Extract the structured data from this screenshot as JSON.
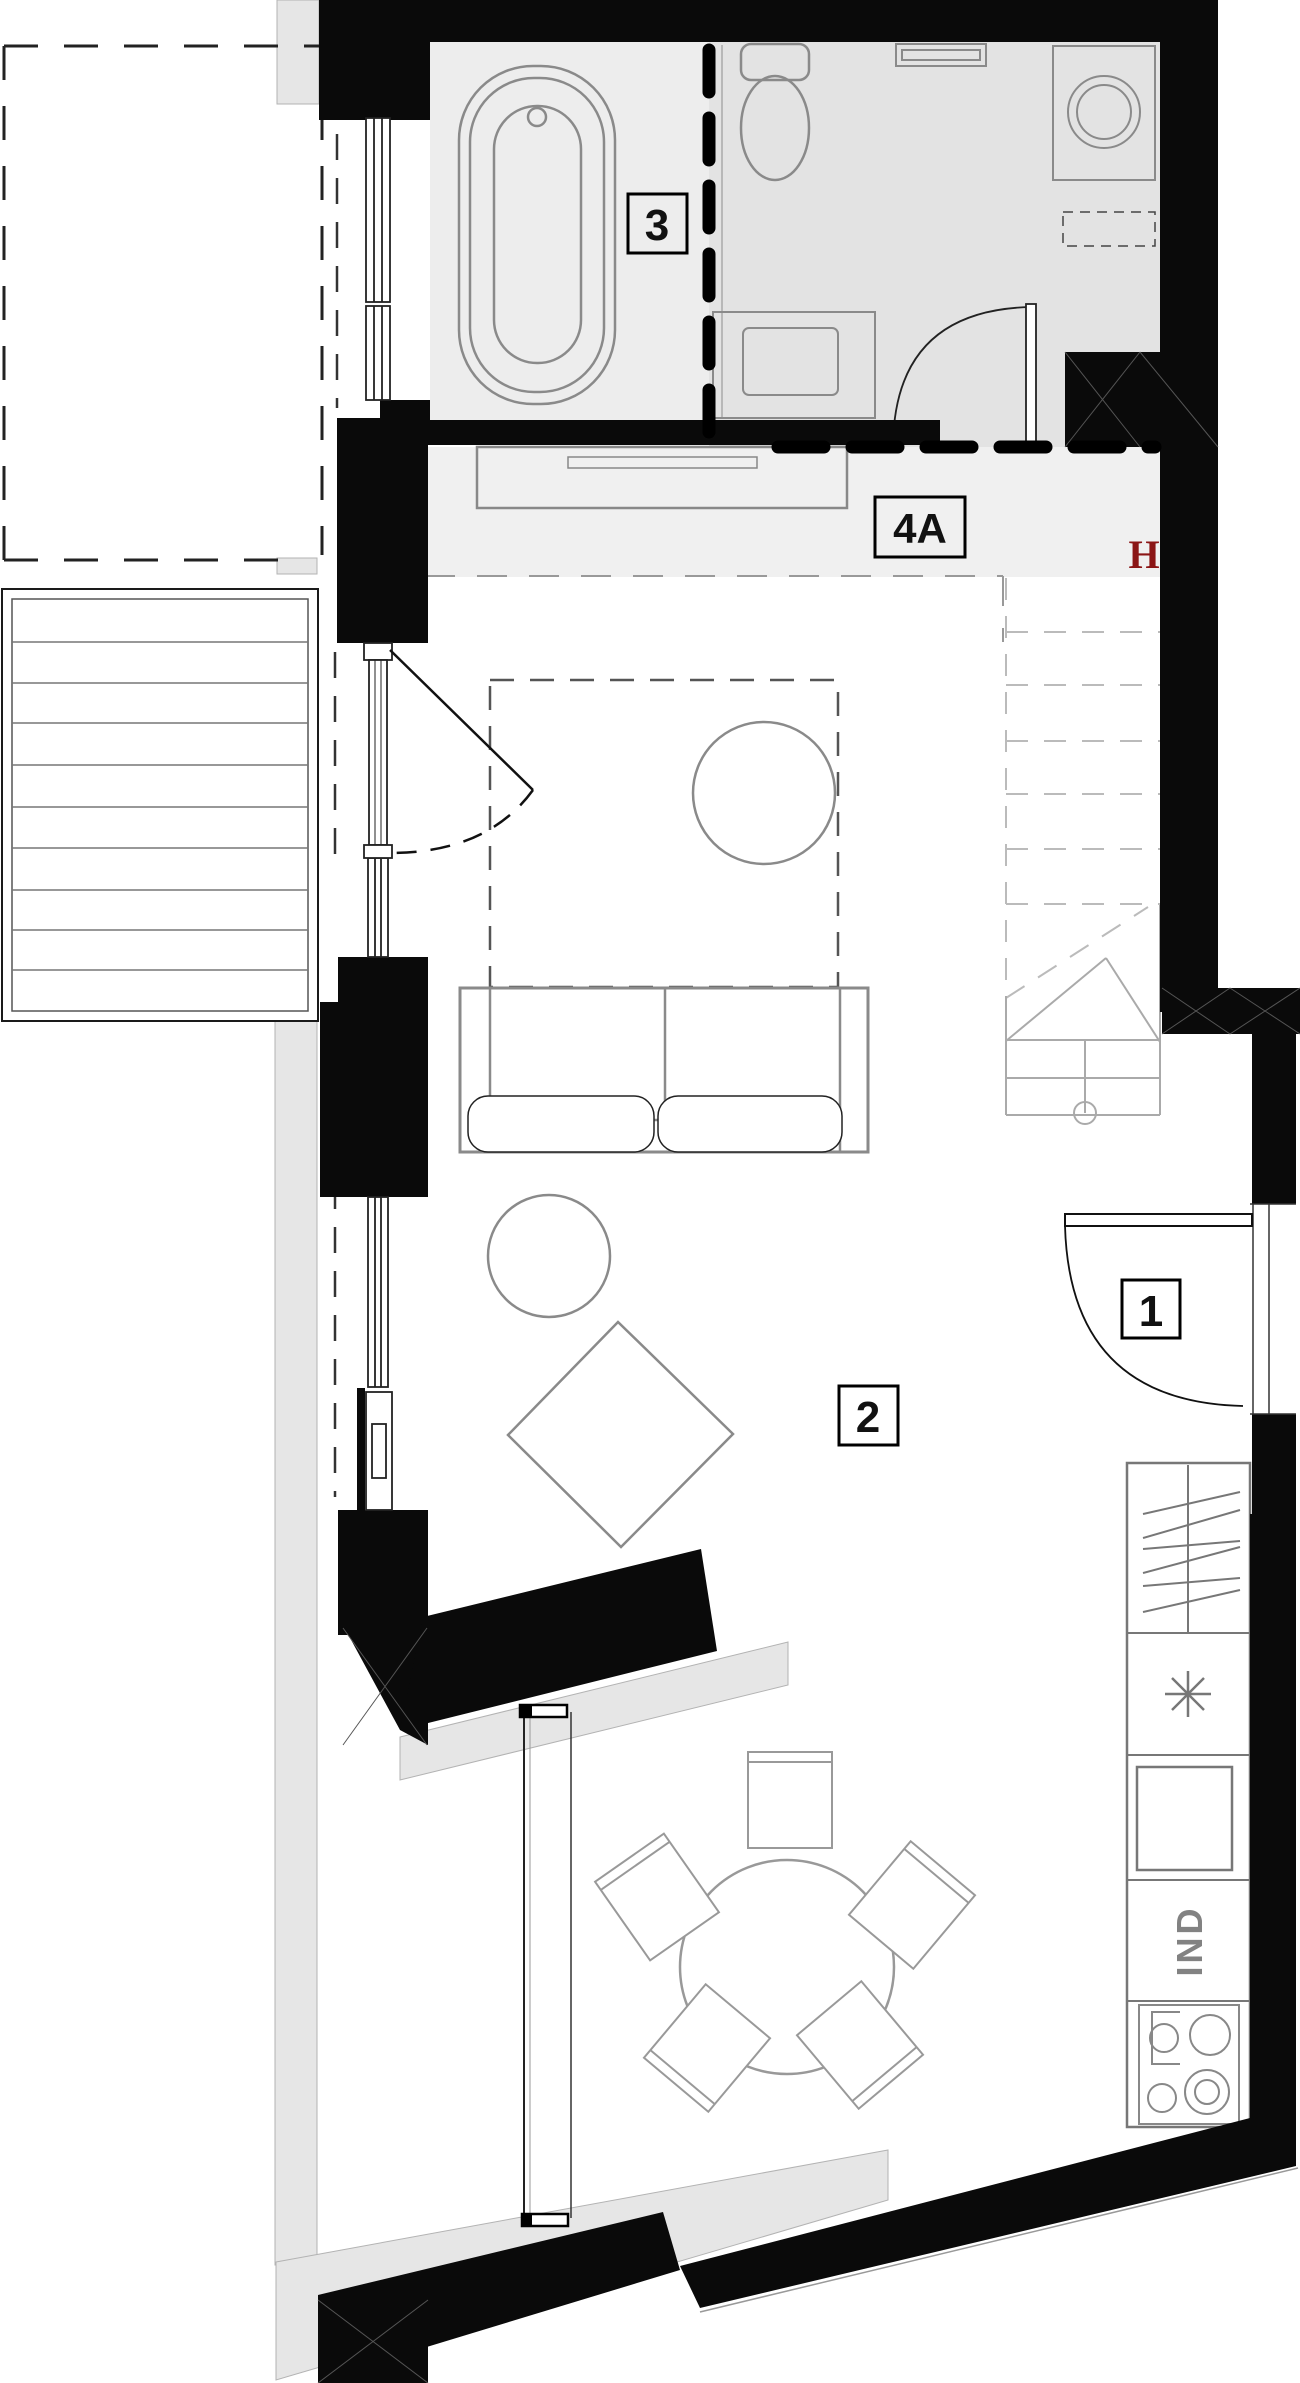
{
  "title": "apartment-floor-plan",
  "labels": {
    "room3": "3",
    "room4a": "4A",
    "room1": "1",
    "room2": "2",
    "beam_marker": "H",
    "induction_hob": "IND"
  },
  "colors": {
    "wall": "#0a0a0a",
    "bath_floor": "#ededed",
    "wc_floor": "#e3e3e3",
    "hall_floor": "#f0f0f0",
    "exterior_strip": "#e6e6e6",
    "furniture_stroke": "#8a8a8a",
    "beam_marker": "#8b1515"
  }
}
